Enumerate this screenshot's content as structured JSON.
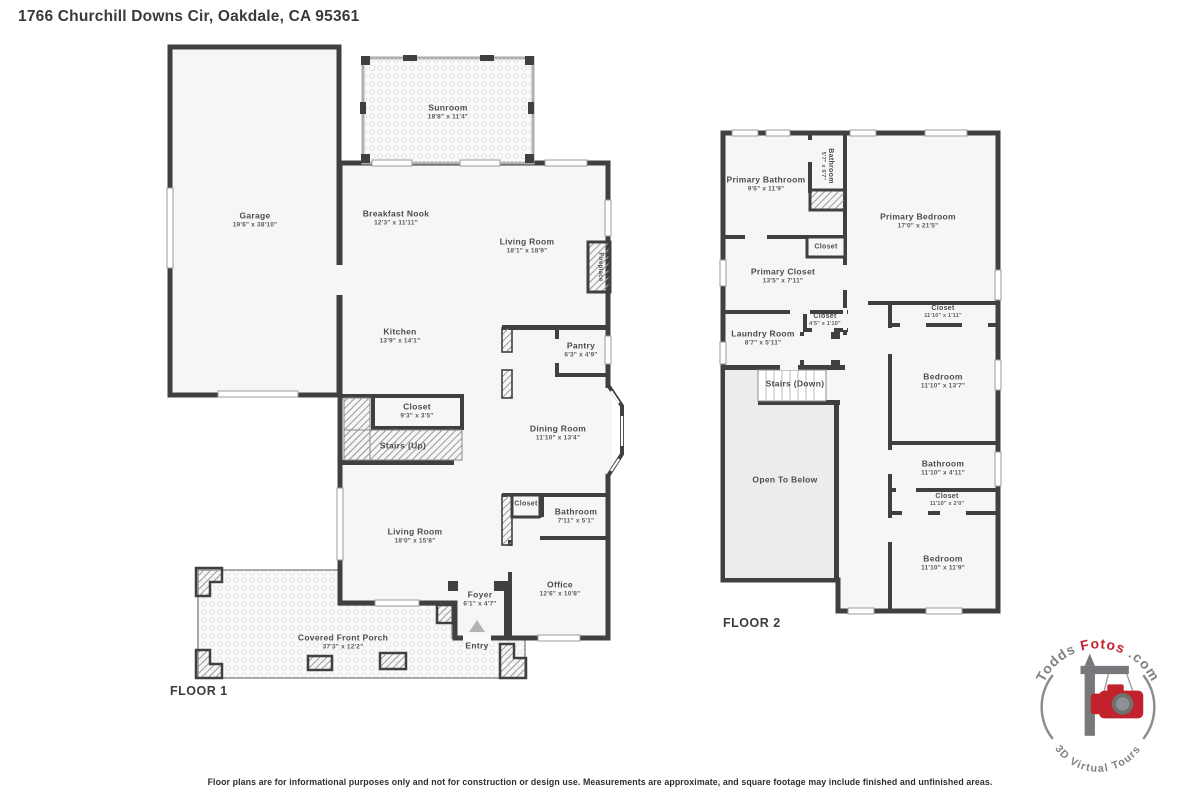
{
  "page": {
    "title": "1766 Churchill Downs Cir, Oakdale, CA 95361",
    "disclaimer": "Floor plans are for informational purposes only and not for construction or design use. Measurements are approximate, and square footage may include finished and unfinished areas."
  },
  "floor1": {
    "label": "FLOOR 1",
    "rooms": {
      "garage": {
        "name": "Garage",
        "dims": "19'6\" x 38'10\""
      },
      "sunroom": {
        "name": "Sunroom",
        "dims": "18'8\" x 11'4\""
      },
      "breakfast_nook": {
        "name": "Breakfast Nook",
        "dims": "12'3\" x 11'11\""
      },
      "living_room_upper": {
        "name": "Living Room",
        "dims": "18'1\" x 18'9\""
      },
      "fireplace": {
        "name": "Fireplace"
      },
      "kitchen": {
        "name": "Kitchen",
        "dims": "13'9\" x 14'1\""
      },
      "pantry": {
        "name": "Pantry",
        "dims": "6'3\" x 4'9\""
      },
      "closet_hall": {
        "name": "Closet",
        "dims": "9'3\" x 3'5\""
      },
      "stairs_up": {
        "name": "Stairs (Up)"
      },
      "dining_room": {
        "name": "Dining Room",
        "dims": "11'10\" x 13'4\""
      },
      "living_room_lower": {
        "name": "Living Room",
        "dims": "18'0\" x 15'8\""
      },
      "closet_entry": {
        "name": "Closet"
      },
      "bathroom": {
        "name": "Bathroom",
        "dims": "7'11\" x 5'1\""
      },
      "foyer": {
        "name": "Foyer",
        "dims": "6'1\" x 4'7\""
      },
      "office": {
        "name": "Office",
        "dims": "12'6\" x 10'8\""
      },
      "entry": {
        "name": "Entry"
      },
      "porch": {
        "name": "Covered Front Porch",
        "dims": "37'3\" x 12'2\""
      }
    }
  },
  "floor2": {
    "label": "FLOOR 2",
    "rooms": {
      "primary_bathroom": {
        "name": "Primary Bathroom",
        "dims": "9'6\" x 11'9\""
      },
      "bathroom_small": {
        "name": "Bathroom",
        "dims": "5'7\" x 6'7\""
      },
      "primary_bedroom": {
        "name": "Primary Bedroom",
        "dims": "17'0\" x 21'5\""
      },
      "closet_small": {
        "name": "Closet"
      },
      "primary_closet": {
        "name": "Primary Closet",
        "dims": "13'5\" x 7'11\""
      },
      "closet_hall": {
        "name": "Closet",
        "dims": "4'5\" x 1'10\""
      },
      "laundry_room": {
        "name": "Laundry Room",
        "dims": "8'7\" x 5'11\""
      },
      "stairs_down": {
        "name": "Stairs (Down)"
      },
      "open_to_below": {
        "name": "Open To Below"
      },
      "closet_bedroom1": {
        "name": "Closet",
        "dims": "11'10\" x 1'11\""
      },
      "bedroom1": {
        "name": "Bedroom",
        "dims": "11'10\" x 13'7\""
      },
      "bathroom_right": {
        "name": "Bathroom",
        "dims": "11'10\" x 4'11\""
      },
      "closet_bedroom2": {
        "name": "Closet",
        "dims": "11'10\" x 2'0\""
      },
      "bedroom2": {
        "name": "Bedroom",
        "dims": "11'10\" x 11'9\""
      }
    }
  },
  "logo": {
    "brand_part1": "Todds",
    "brand_part2": "Fotos",
    "brand_part3": ".com",
    "tagline": "3D Virtual Tours",
    "colors": {
      "red": "#c2222b",
      "gray": "#808285"
    }
  },
  "colors": {
    "wall": "#404040",
    "room_fill": "#f6f6f6",
    "open_fill": "#ececec"
  }
}
